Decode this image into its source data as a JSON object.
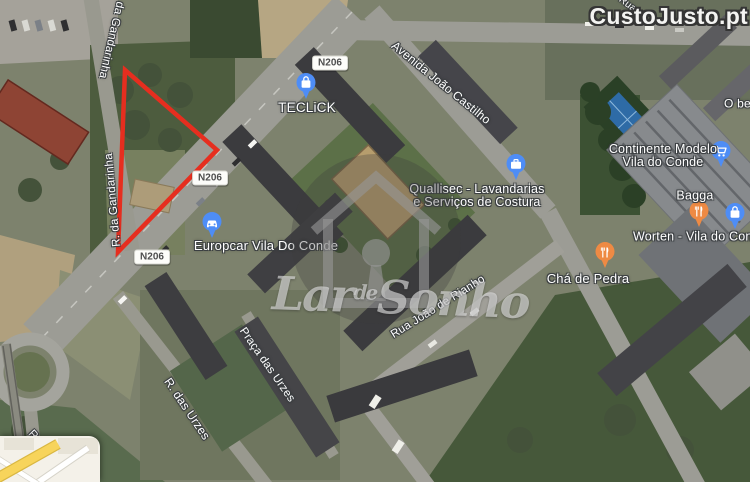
{
  "watermarks": {
    "portal": "CustoJusto.pt",
    "agency": {
      "word1": "Lar",
      "word2": "de",
      "word3": "Sonho"
    }
  },
  "road_badges": [
    {
      "label": "N206"
    },
    {
      "label": "N206"
    },
    {
      "label": "N206"
    }
  ],
  "street_labels": [
    {
      "text": "da Gandarinha"
    },
    {
      "text": "R. da Gandarinha"
    },
    {
      "text": "Avenida João Castilho"
    },
    {
      "text": "Rua João de Rianho"
    },
    {
      "text": "R. das Urzes"
    },
    {
      "text": "Praça das Urzes"
    },
    {
      "text": "R. da Libe"
    },
    {
      "text": "Rua"
    }
  ],
  "places": [
    {
      "name": "TECLiCK",
      "lines": [
        "TECLiCK"
      ],
      "pin": "shopping-bag",
      "pin_color": "#4e8df6"
    },
    {
      "name": "Quallisec - Lavandarias e Serviços de Costura",
      "lines": [
        "Quallisec - Lavandarias",
        "e Serviços de Costura"
      ],
      "pin": "briefcase",
      "pin_color": "#4e8df6"
    },
    {
      "name": "Europcar Vila Do Conde",
      "lines": [
        "Europcar Vila Do Conde"
      ],
      "pin": "car-rental",
      "pin_color": "#4e8df6"
    },
    {
      "name": "Continente Modelo Vila do Conde",
      "lines": [
        "Continente Modelo",
        "Vila do Conde"
      ],
      "pin": "shopping-cart",
      "pin_color": "#4e8df6"
    },
    {
      "name": "Bagga",
      "lines": [
        "Bagga"
      ],
      "pin": "restaurant",
      "pin_color": "#ee8a44"
    },
    {
      "name": "Worten - Vila do Conde",
      "lines": [
        "Worten - Vila do Conde"
      ],
      "pin": "shopping-bag",
      "pin_color": "#4e8df6"
    },
    {
      "name": "Chá de Pedra",
      "lines": [
        "Chá de Pedra"
      ],
      "pin": "restaurant",
      "pin_color": "#ee8a44"
    },
    {
      "name": "O be",
      "lines": [
        "O be"
      ],
      "pin": null,
      "pin_color": null
    }
  ],
  "colors": {
    "pin_blue": "#4e8df6",
    "pin_orange": "#ee8a44",
    "boundary_red": "#e62e1f",
    "badge_bg": "#fdfdfa",
    "badge_text": "#4e4e4e",
    "label_text": "#ffffff"
  }
}
